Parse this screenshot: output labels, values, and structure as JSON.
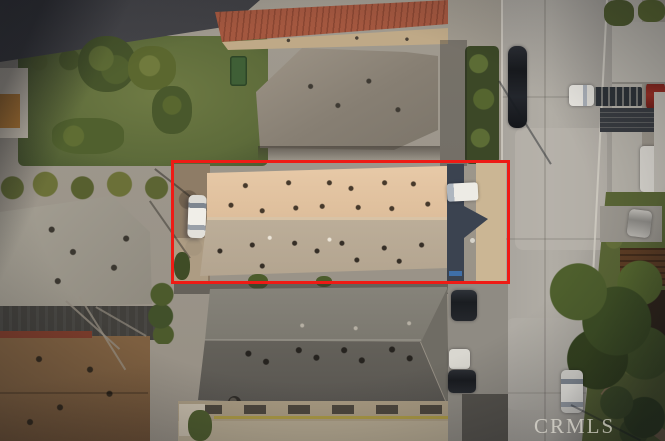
{
  "photo": {
    "description": "Aerial top-down drone view of a residential block; subject property outlined in red",
    "watermark": "CRMLS"
  },
  "colors": {
    "boundary_red": "#ee1b15",
    "watermark": "rgba(232,229,218,0.68)",
    "subject_roof_upper": "#e7c9a7",
    "subject_roof_lower": "#b3a48f",
    "street": "#a8a49d",
    "lawn": "#5d6b3a"
  },
  "objects": {
    "subject_building": "long tan-roof building inside red outline",
    "boundary": "red rectangle around subject lot",
    "vehicles": [
      "white sedan in side yard",
      "white van at building rear",
      "dark car on street top",
      "white truck with loaded flatbed",
      "red car top right",
      "silver car in right driveway",
      "white car on street bottom",
      "dark SUV in rear driveway",
      "white car in rear driveway",
      "dark car in rear driveway"
    ],
    "street": "residential street running vertically at right",
    "neighbors": [
      "red tile roof building top",
      "gray hip-roof house top",
      "light gray roof house left",
      "brown shingle roof house bottom left",
      "dark gray long roof building bottom",
      "tan building bottom"
    ]
  }
}
